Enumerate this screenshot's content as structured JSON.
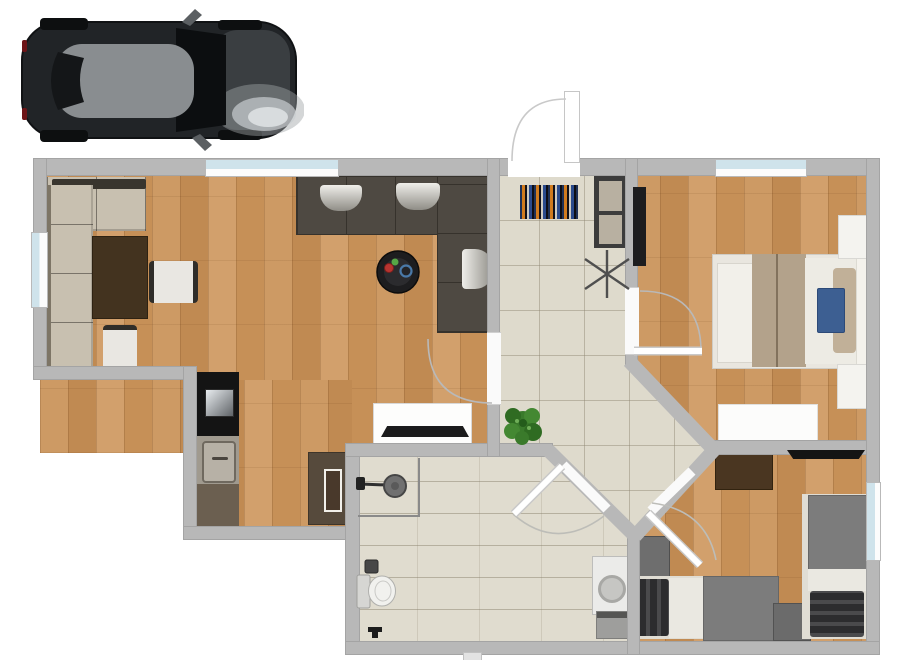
{
  "meta": {
    "width": 905,
    "height": 660,
    "description": "3D-rendered top-down floor plan of a single-storey apartment with a car parked outside (top-left)"
  },
  "palette": {
    "wall": "#b8b8b8",
    "wood_floor": "#c9965f",
    "tile_floor": "#dedacc",
    "window_glass": "#cfe3eb",
    "sofa_dark": "#4e4942",
    "sofa_beige": "#c8c0b0",
    "bed_blanket_tan": "#b3a28b",
    "pillow_blue": "#3d5f92",
    "furniture_gray": "#7c7c7c",
    "desk_brown": "#43331f",
    "plant_green": "#3a7a2b",
    "car_body": "#212427"
  },
  "vehicle": {
    "name": "car-top-view",
    "color": "#212427",
    "position": "outside top-left"
  },
  "rooms": [
    {
      "name": "living-room",
      "floor": "wood",
      "furniture": [
        "beige-corner-sofa",
        "dark-writing-desk",
        "chair",
        "chair",
        "dark-corner-sofa",
        "white-seat-cushions",
        "round-coffee-table",
        "tv-sideboard",
        "tv"
      ]
    },
    {
      "name": "kitchen-dining",
      "floor": "wood",
      "furniture": [
        "cooktop-counter",
        "sink-counter",
        "worktop",
        "dining-table",
        "serving-tray"
      ]
    },
    {
      "name": "hallway",
      "floor": "tile",
      "furniture": [
        "entrance-door",
        "striped-doormat",
        "shoe-cabinet",
        "drying-rack",
        "potted-plant"
      ]
    },
    {
      "name": "bedroom-main",
      "floor": "wood",
      "furniture": [
        "wall-tv",
        "double-bed",
        "blue-pillow",
        "nightstand",
        "nightstand",
        "dresser"
      ]
    },
    {
      "name": "bathroom",
      "floor": "tile",
      "furniture": [
        "corner-shower",
        "toilet",
        "toilet-paper-holder",
        "toilet-brush",
        "washing-machine",
        "laundry-box"
      ]
    },
    {
      "name": "bedroom-second",
      "floor": "wood",
      "furniture": [
        "desk",
        "wall-tv",
        "gray-cabinet",
        "single-bed-horizontal",
        "single-bed-vertical",
        "gray-cube-nightstand"
      ]
    }
  ],
  "openings": {
    "windows": [
      "living-room-top",
      "living-room-left",
      "bedroom-main-top",
      "bedroom-second-right"
    ],
    "doors": [
      "entrance",
      "living-room",
      "bedroom-main",
      "bathroom",
      "bedroom-second"
    ]
  }
}
